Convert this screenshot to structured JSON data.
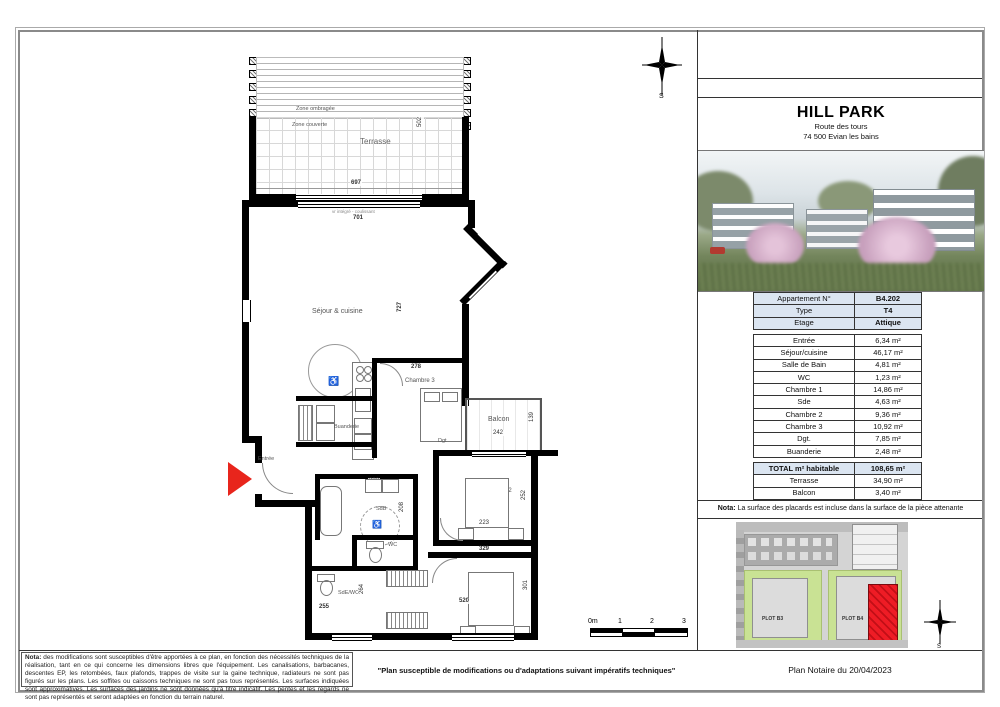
{
  "sheet": {
    "project_name": "HILL PARK",
    "address_line1": "Route des tours",
    "address_line2": "74 500 Evian les bains"
  },
  "info_table": {
    "rows": [
      {
        "label": "Appartement N°",
        "value": "B4.202"
      },
      {
        "label": "Type",
        "value": "T4"
      },
      {
        "label": "Etage",
        "value": "Attique"
      }
    ]
  },
  "surface_table": {
    "rows": [
      {
        "label": "Entrée",
        "value": "6,34 m²"
      },
      {
        "label": "Séjour/cuisine",
        "value": "46,17 m²"
      },
      {
        "label": "Salle de Bain",
        "value": "4,81 m²"
      },
      {
        "label": "WC",
        "value": "1,23 m²"
      },
      {
        "label": "Chambre 1",
        "value": "14,86 m²"
      },
      {
        "label": "Sde",
        "value": "4,63 m²"
      },
      {
        "label": "Chambre 2",
        "value": "9,36 m²"
      },
      {
        "label": "Chambre 3",
        "value": "10,92 m²"
      },
      {
        "label": "Dgt.",
        "value": "7,85 m²"
      },
      {
        "label": "Buanderie",
        "value": "2,48 m²"
      }
    ]
  },
  "total_table": {
    "rows": [
      {
        "label": "TOTAL m² habitable",
        "value": "108,65 m²"
      },
      {
        "label": "Terrasse",
        "value": "34,90 m²"
      },
      {
        "label": "Balcon",
        "value": "3,40 m²"
      }
    ]
  },
  "nota": {
    "bold": "Nota:",
    "text": " La surface des placards est incluse dans la surface de la pièce attenante"
  },
  "site_plan": {
    "plot_left": "PLOT B3",
    "plot_right": "PLOT B4"
  },
  "plan": {
    "labels": {
      "terrasse": "Terrasse",
      "zone_ombragee": "Zone ombragée",
      "zone_couverte": "Zone couverte",
      "sejour": "Séjour & cuisine",
      "chambre3": "Chambre 3",
      "buanderie": "Buanderie",
      "entree": "Entrée",
      "dgt": "Dgt",
      "balcon": "Balcon",
      "chambre2": "Chambre 2",
      "chambre1": "Chambre 1",
      "sdb": "SdB",
      "wc": "WC",
      "sde_wc": "SdE/WC"
    },
    "dims": {
      "terrace_width": "697",
      "terrace_depth": "502",
      "living_width": "701",
      "living_height": "727",
      "bedroom3_width": "278",
      "balcony_width": "242",
      "balcony_depth": "139",
      "bedroom2_height": "252",
      "bedroom2_width": "223",
      "hall_width": "329",
      "bedroom1_height": "301",
      "bedroom1_width": "520",
      "sde_width": "255",
      "sde_height": "264",
      "sdb_height": "208",
      "sdb_width": "232"
    },
    "annotations": {
      "door_note": "vr intégré - coulissant"
    },
    "scale_bar": {
      "labels": [
        "0m",
        "1",
        "2",
        "3"
      ]
    },
    "compass": {
      "letter": "S"
    }
  },
  "footer": {
    "notes_bold": "Nota:",
    "notes_text": " des modifications sont susceptibles d'être apportées à ce plan, en fonction des nécessités techniques de la réalisation, tant en ce qui concerne les dimensions libres que l'équipement. Les canalisations, barbacanes, descentes EP, les retombées, faux plafonds, trappes de visite sur la gaine technique, radiateurs ne sont pas figurés sur les plans. Les soffites ou caissons techniques ne sont pas tous représentés. Les surfaces indiquées sont approximatives. Les surfaces des jardins ne sont données qu'à titre indicatif. Les pentes et les regards ne sont pas représentés et seront adaptées en fonction du terrain naturel.",
    "quote": "\"Plan susceptible de modifications ou d'adaptations suivant impératifs techniques\"",
    "date": "Plan Notaire du 20/04/2023"
  }
}
